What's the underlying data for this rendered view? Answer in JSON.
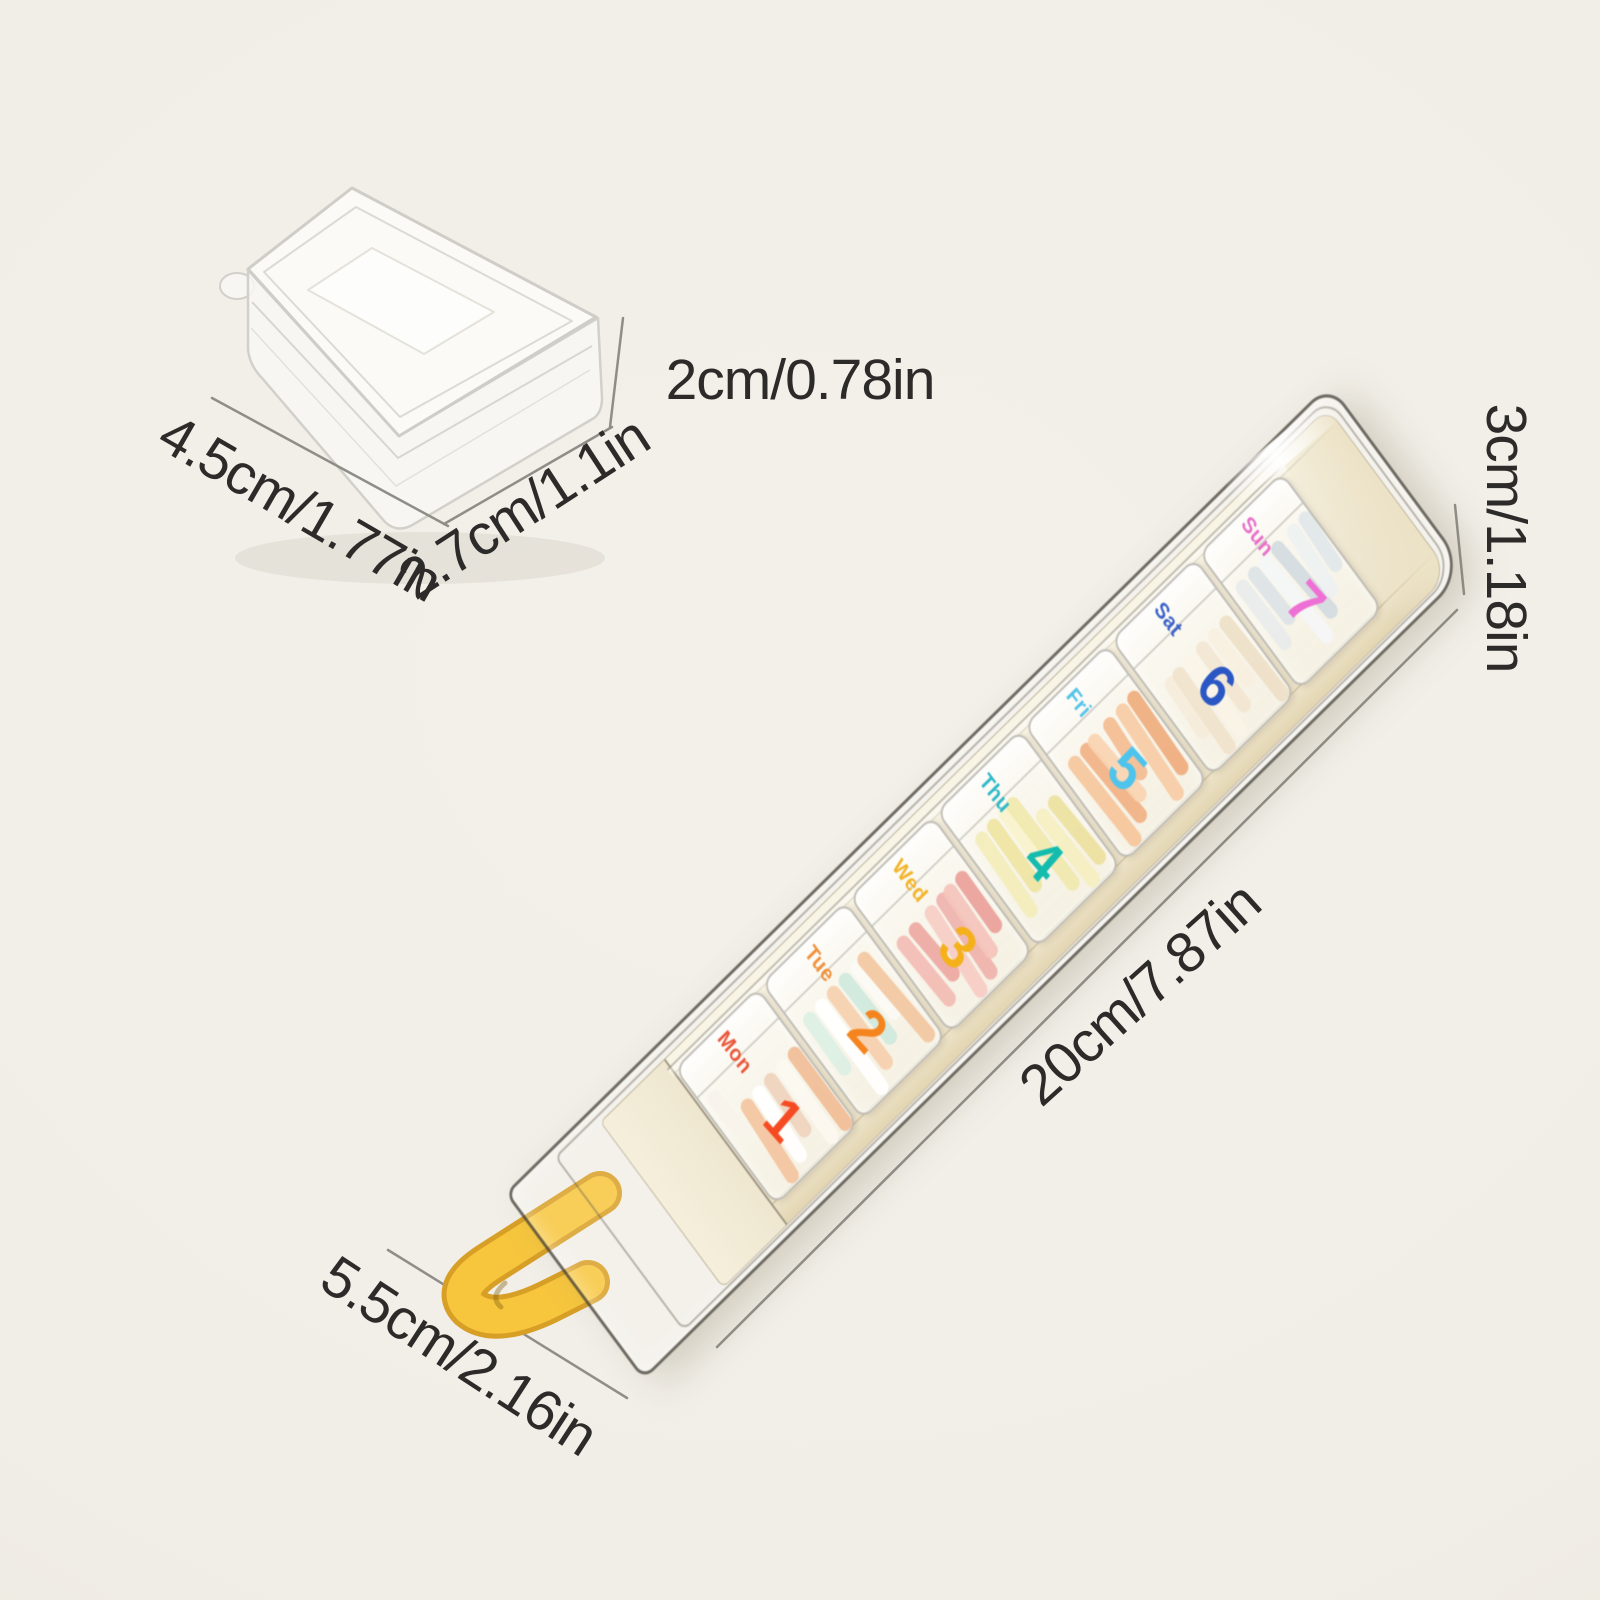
{
  "scene": {
    "background": "#f3f0ea",
    "dimension_text_color": "#2c2b29",
    "dimension_line_color": "#8f8d88"
  },
  "daily_box": {
    "width_label": "4.5cm/1.77in",
    "depth_label": "2.7cm/1.1in",
    "height_label": "2cm/0.78in"
  },
  "organizer": {
    "length_label": "20cm/7.87in",
    "width_label": "5.5cm/2.16in",
    "height_label": "3cm/1.18in",
    "pull_tab_color": "#f7c63d",
    "tray_color": "#f2ebd6",
    "compartments": [
      {
        "day": "Mon",
        "number": "1",
        "day_color": "#e9573a",
        "number_color": "#f64b22",
        "pill_colors": [
          "#f9f3ea",
          "#f3c4a0",
          "#ffffff",
          "#efd3bd",
          "#fcf8f1",
          "#f0bd96"
        ]
      },
      {
        "day": "Tue",
        "number": "2",
        "day_color": "#f0913b",
        "number_color": "#f5841f",
        "pill_colors": [
          "#dcefe3",
          "#ffffff",
          "#f5cfae",
          "#cfe9dd",
          "#fbfaf4",
          "#f2c7a1"
        ]
      },
      {
        "day": "Wed",
        "number": "3",
        "day_color": "#f2b42c",
        "number_color": "#f4b119",
        "pill_colors": [
          "#f2bcb4",
          "#eda8a2",
          "#f6ccc4",
          "#efb2ac",
          "#f4c3bb",
          "#eaa09a"
        ]
      },
      {
        "day": "Thu",
        "number": "4",
        "day_color": "#2fb9c9",
        "number_color": "#14bcae",
        "pill_colors": [
          "#f3edba",
          "#eee4a2",
          "#f8f3cc",
          "#f0e8ae",
          "#f5efc0",
          "#ece19e"
        ]
      },
      {
        "day": "Fri",
        "number": "5",
        "day_color": "#54c3e9",
        "number_color": "#4ec4ec",
        "pill_colors": [
          "#f5c59b",
          "#f1b184",
          "#f8d4b1",
          "#f3bc91",
          "#f6cca5",
          "#efac7d"
        ]
      },
      {
        "day": "Sat",
        "number": "6",
        "day_color": "#3c63c9",
        "number_color": "#2b57c5",
        "pill_colors": [
          "#f5ecda",
          "#f0e3cc",
          "#faf4e7",
          "#f2e6d2",
          "#f7efdf",
          "#eedfc7"
        ]
      },
      {
        "day": "Sun",
        "number": "7",
        "day_color": "#e86fc9",
        "number_color": "#ef70d4",
        "pill_colors": [
          "#e8eceb",
          "#dce3e6",
          "#f4f6f6",
          "#d2dbdf",
          "#edf1f1",
          "#e1e7e9"
        ]
      }
    ]
  }
}
